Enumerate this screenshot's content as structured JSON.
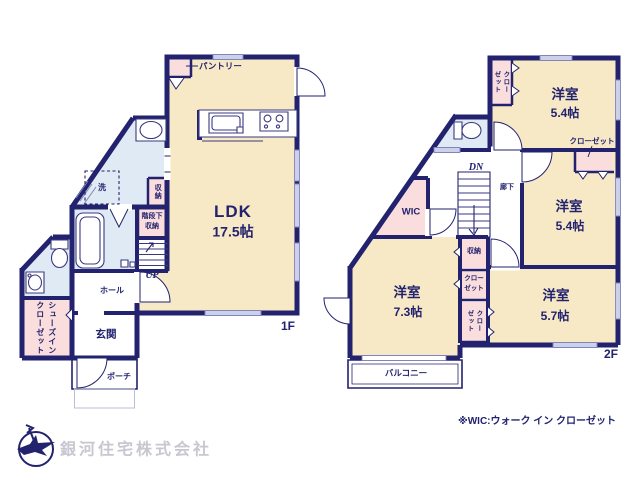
{
  "colors": {
    "wall": "#22226f",
    "room_cream": "#f7e8c6",
    "water_blue": "#dfeaf4",
    "closet_pink": "#fadedd",
    "window_gray": "#ccd0e8",
    "company_text": "#c7c7d1"
  },
  "floor1": {
    "floor_label": "1F",
    "ldk_name": "LDK",
    "ldk_size": "17.5帖",
    "pantry": "パントリー",
    "laundry": "洗",
    "storage_vertical": "収納",
    "under_stairs_line1": "階段下",
    "under_stairs_line2": "収納",
    "stairs_up": "UP",
    "hall": "ホール",
    "entrance": "玄関",
    "shoes_closet_col1": "シューズイン",
    "shoes_closet_col2": "クローゼット",
    "porch": "ポーチ"
  },
  "floor2": {
    "floor_label": "2F",
    "room1_name": "洋室",
    "room1_size": "5.4帖",
    "room2_name": "洋室",
    "room2_size": "5.4帖",
    "room3_name": "洋室",
    "room3_size": "5.7帖",
    "room4_name": "洋室",
    "room4_size": "7.3帖",
    "closet_top_col1": "クロー",
    "closet_top_col2": "ゼット",
    "closet_pointer_label": "クローゼット",
    "stairs_dn": "DN",
    "corridor": "廊下",
    "wic": "WIC",
    "storage": "収納",
    "closet_mid_line1": "クロー",
    "closet_mid_line2": "ゼット",
    "closet_v_col1": "クロー",
    "closet_v_col2": "ゼット",
    "balcony": "バルコニー"
  },
  "footer": {
    "wic_note": "※WIC:ウォーク イン クローゼット",
    "company_name": "銀河住宅株式会社"
  }
}
